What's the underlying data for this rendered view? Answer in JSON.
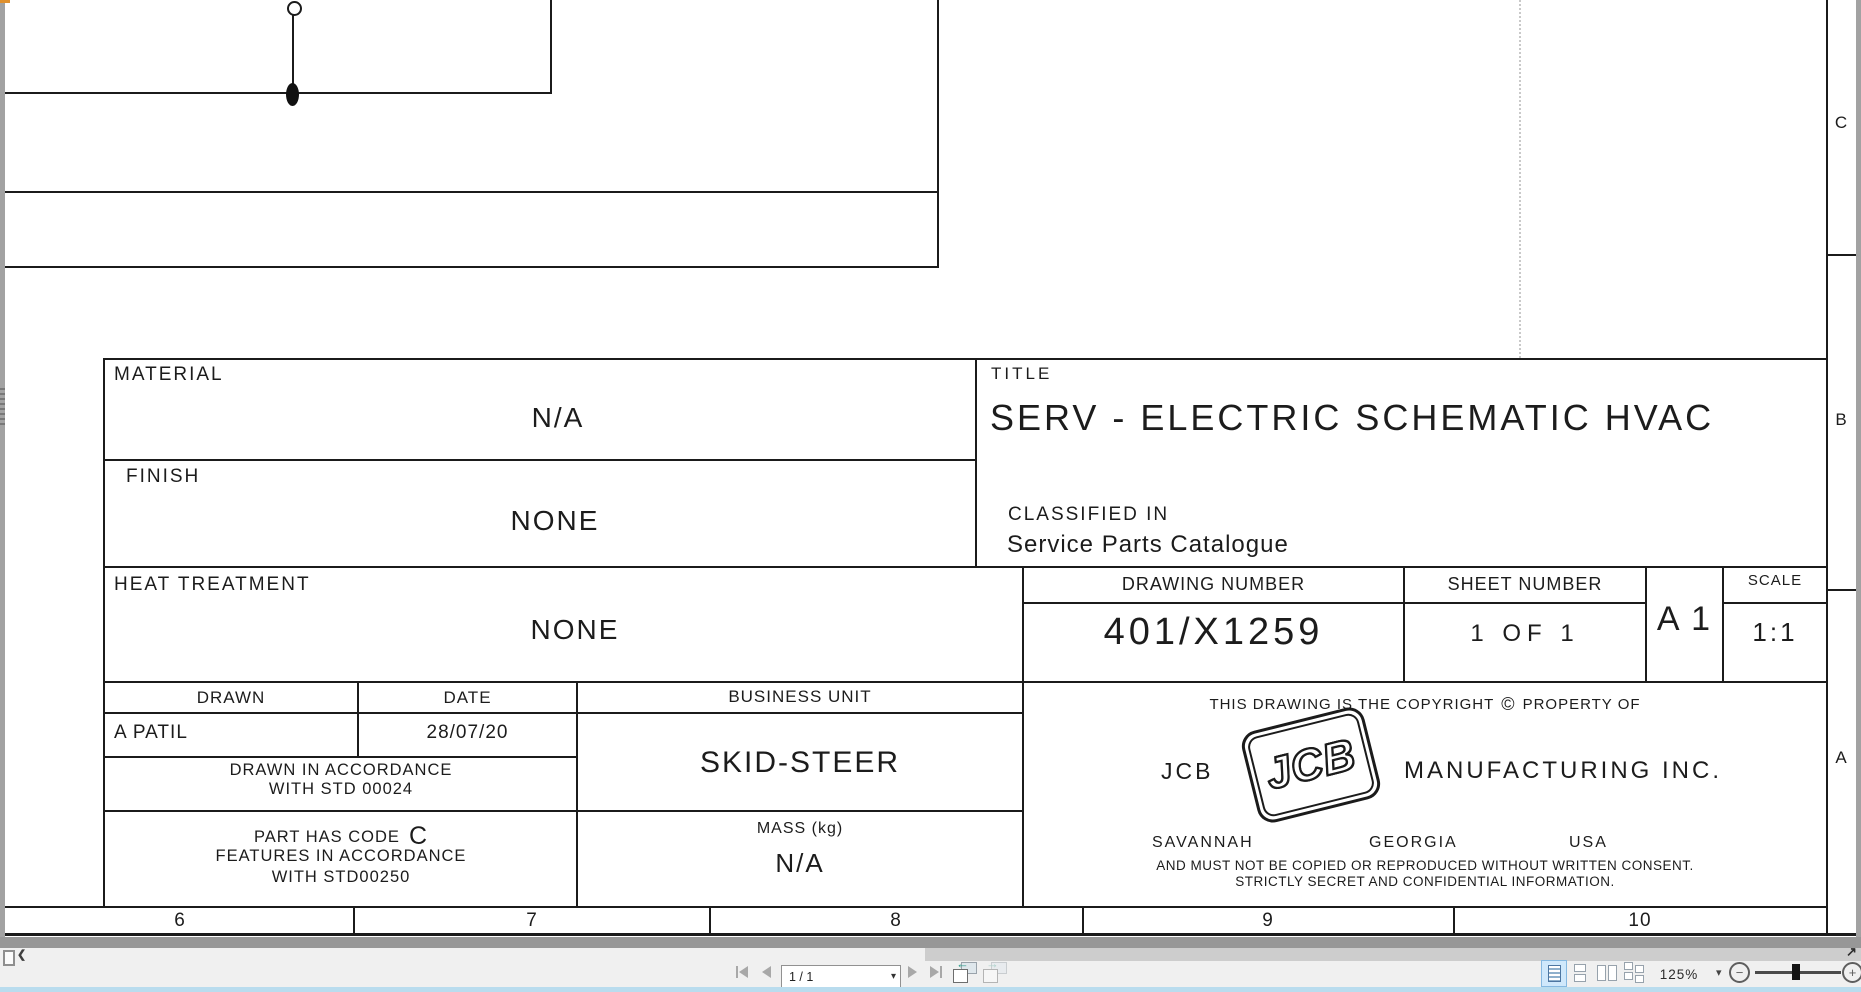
{
  "drawing": {
    "material_label": "MATERIAL",
    "material_value": "N/A",
    "finish_label": "FINISH",
    "finish_value": "NONE",
    "heat_label": "HEAT TREATMENT",
    "heat_value": "NONE",
    "title_label": "TITLE",
    "title_value": "SERV - ELECTRIC SCHEMATIC HVAC",
    "classified_label": "CLASSIFIED IN",
    "classified_value": "Service Parts Catalogue",
    "drawing_number_label": "DRAWING NUMBER",
    "drawing_number_value": "401/X1259",
    "sheet_number_label": "SHEET NUMBER",
    "sheet_number_value": "1 OF 1",
    "sheet_size": "A 1",
    "scale_label": "SCALE",
    "scale_value": "1:1",
    "drawn_label": "DRAWN",
    "drawn_value": "A PATIL",
    "date_label": "DATE",
    "date_value": "28/07/20",
    "business_unit_label": "BUSINESS UNIT",
    "business_unit_value": "SKID-STEER",
    "drawn_note_line1": "DRAWN IN ACCORDANCE",
    "drawn_note_line2": "WITH STD 00024",
    "part_code_line1": "PART HAS CODE",
    "part_code_letter": "C",
    "part_code_line2": "FEATURES IN ACCORDANCE",
    "part_code_line3": "WITH STD00250",
    "mass_label": "MASS (kg)",
    "mass_value": "N/A",
    "copyright_prefix": "THIS DRAWING IS THE COPYRIGHT",
    "copyright_symbol": "©",
    "copyright_suffix": "PROPERTY OF",
    "company_prefix": "JCB",
    "logo_text": "JCB",
    "company_suffix": "MANUFACTURING INC.",
    "location_city": "SAVANNAH",
    "location_state": "GEORGIA",
    "location_country": "USA",
    "legal_line1": "AND MUST NOT BE COPIED OR REPRODUCED WITHOUT WRITTEN CONSENT.",
    "legal_line2": "STRICTLY SECRET AND CONFIDENTIAL INFORMATION.",
    "zone_numbers": [
      "6",
      "7",
      "8",
      "9",
      "10"
    ],
    "zone_letters": [
      "C",
      "B",
      "A"
    ]
  },
  "statusbar": {
    "page_field_value": "1 / 1",
    "zoom_level": "125%"
  },
  "glyphs": {
    "chevron_left": "❮",
    "caret_down": "▾",
    "minus": "−",
    "plus": "+",
    "arrow_up_right": "↗",
    "arrow_left": "←",
    "arrow_right": "→"
  },
  "colors": {
    "toolbar_bg": "#f0f0f0",
    "viewer_margin": "#a2a2a2",
    "scrollbar_thumb": "#cdcdcd",
    "bottom_strip_blue": "#b9dcee",
    "selected_layout_bg": "#cfe8fb",
    "selected_layout_border": "#85b8e0",
    "view_arrow_teal": "#2f9d8c",
    "drawing_ink": "#1b1b1b"
  }
}
